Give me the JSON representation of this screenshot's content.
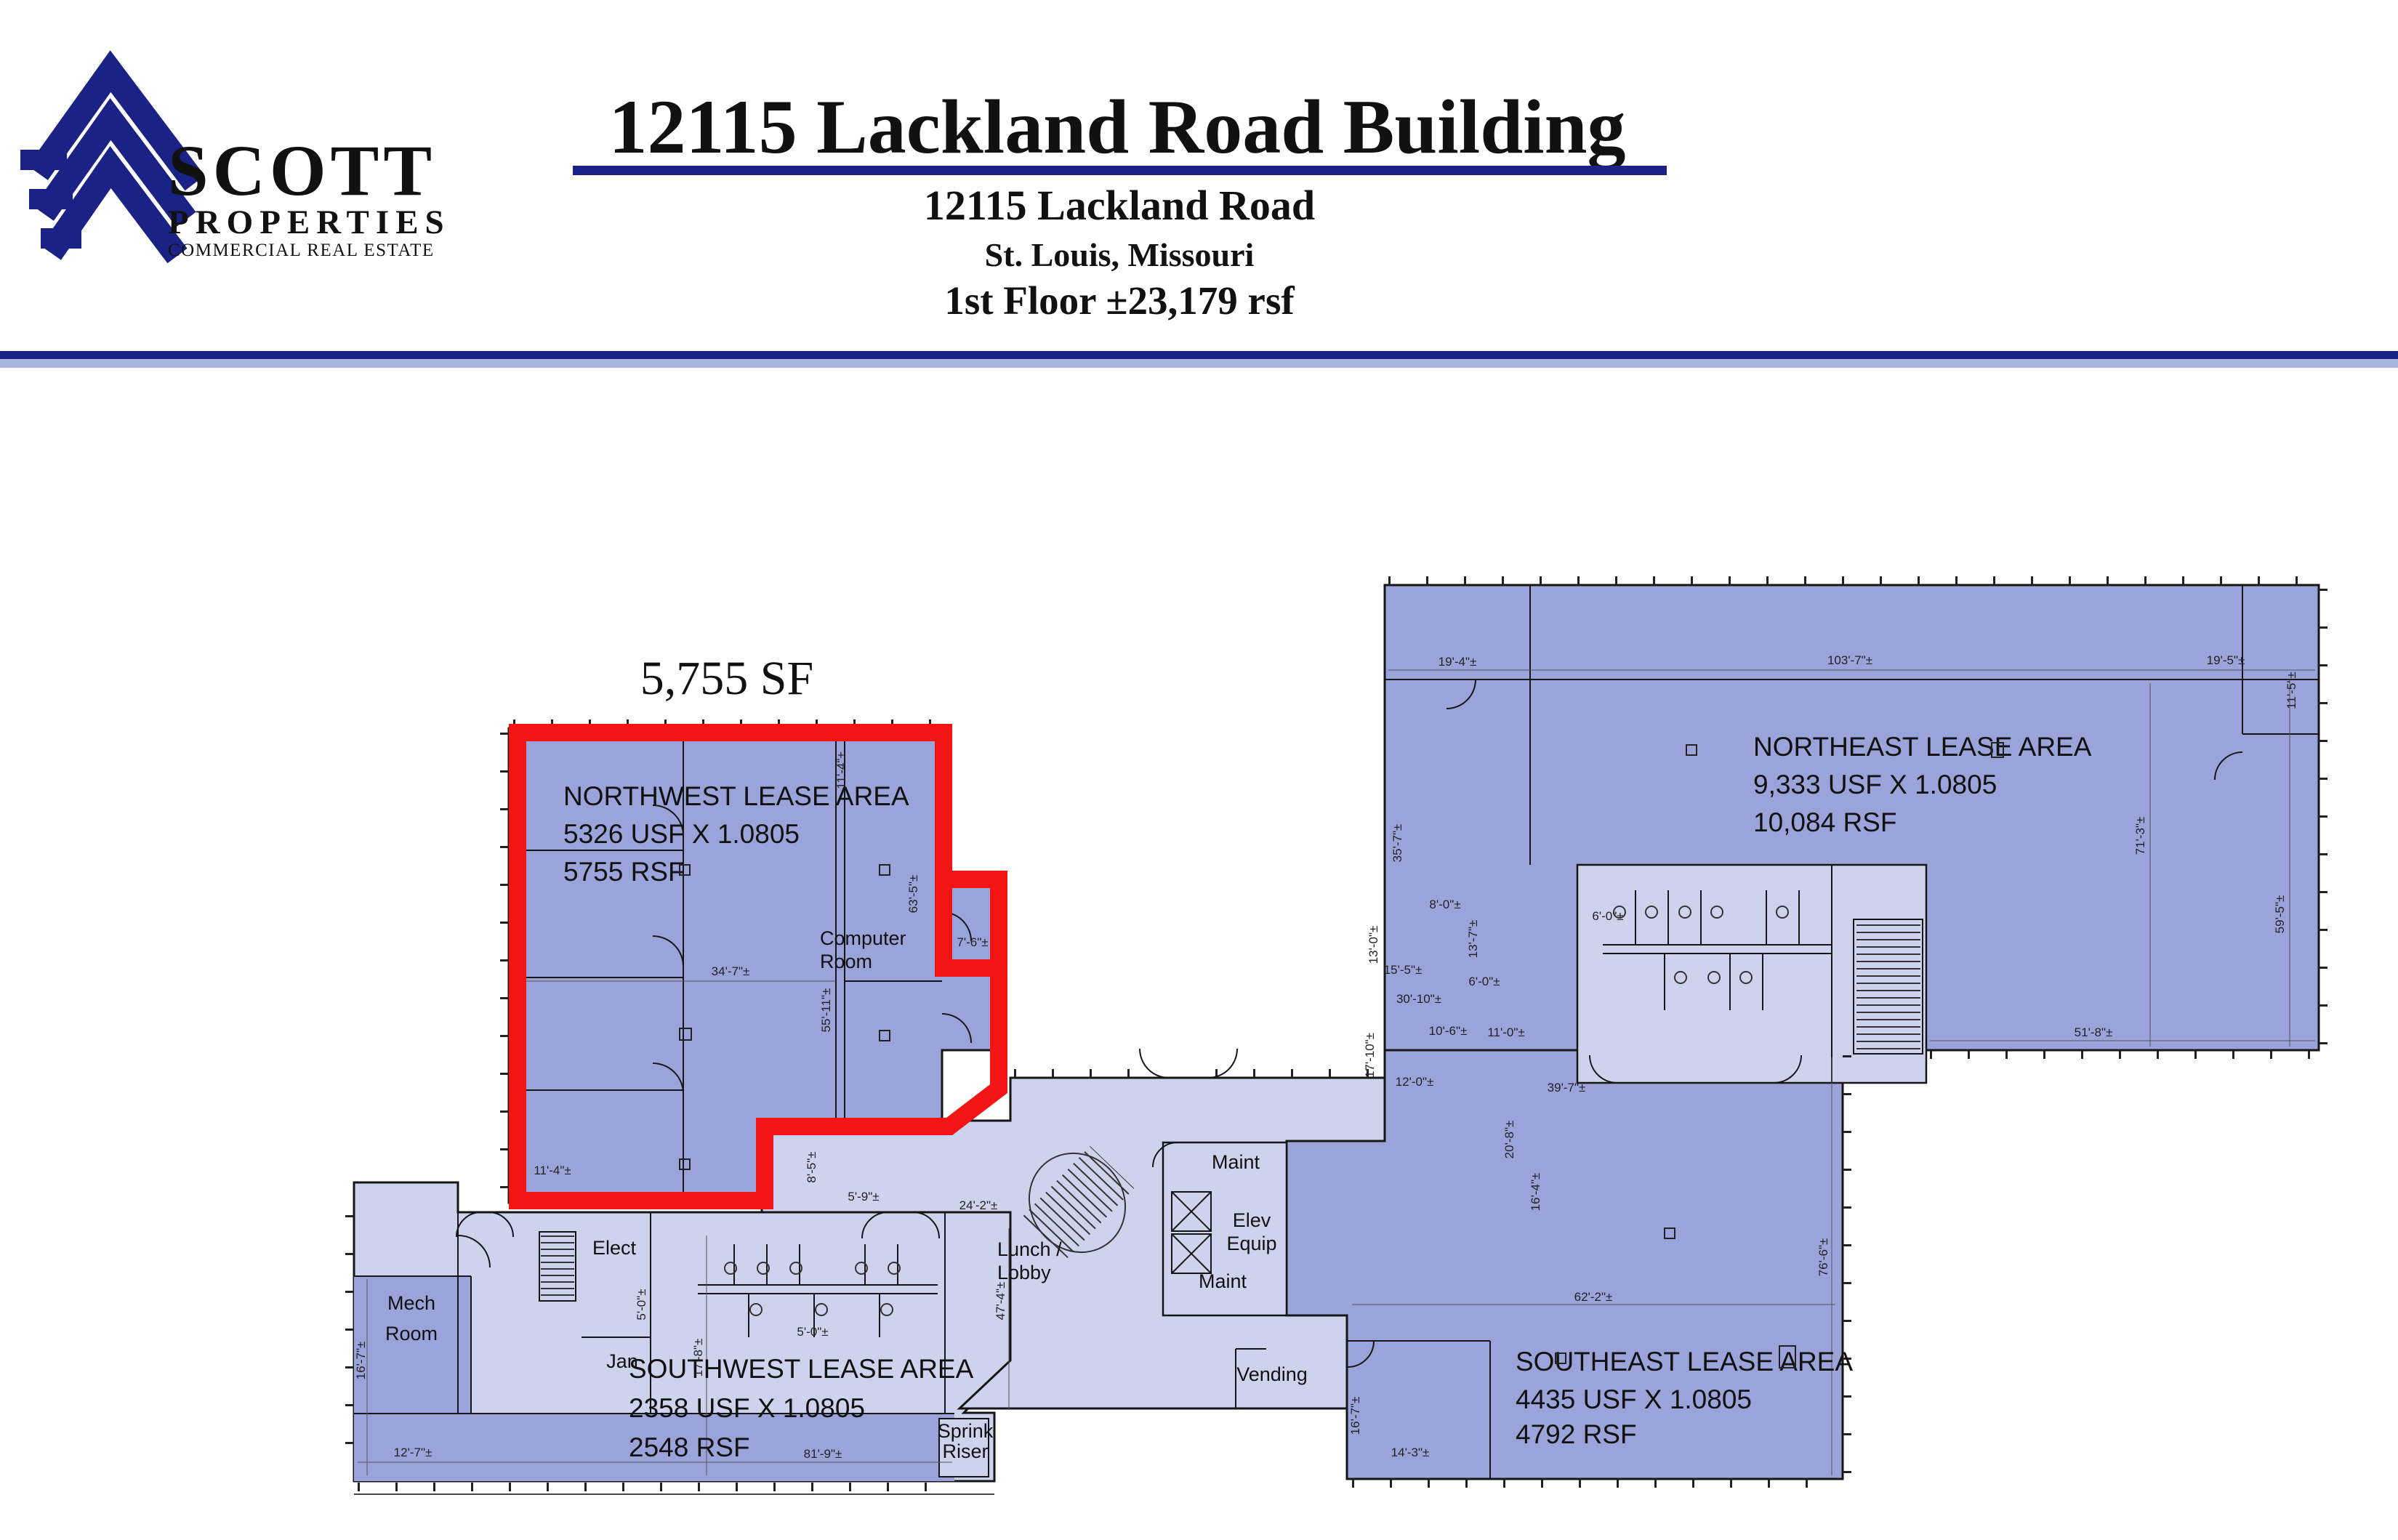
{
  "header": {
    "logo": {
      "line1": "SCOTT",
      "line2": "PROPERTIES",
      "line3": "COMMERCIAL REAL ESTATE"
    },
    "title": "12115 Lackland Road Building",
    "address": "12115 Lackland Road",
    "city": "St. Louis, Missouri",
    "floor": "1st Floor  ±23,179 rsf"
  },
  "plan": {
    "highlight_sf": "5,755 SF",
    "areas": {
      "northwest": {
        "name": "NORTHWEST LEASE AREA",
        "usf": "5326 USF X 1.0805",
        "rsf": "5755 RSF"
      },
      "northeast": {
        "name": "NORTHEAST LEASE AREA",
        "usf": "9,333 USF X 1.0805",
        "rsf": "10,084 RSF"
      },
      "southwest": {
        "name": "SOUTHWEST LEASE AREA",
        "usf": "2358 USF X 1.0805",
        "rsf": "2548 RSF"
      },
      "southeast": {
        "name": "SOUTHEAST LEASE AREA",
        "usf": "4435 USF X 1.0805",
        "rsf": "4792 RSF"
      }
    },
    "rooms": {
      "computer1": "Computer",
      "computer2": "Room",
      "mech1": "Mech",
      "mech2": "Room",
      "elect": "Elect",
      "jan": "Jan",
      "lunch1": "Lunch /",
      "lunch2": "Lobby",
      "vending": "Vending",
      "maint_upper": "Maint",
      "maint_lower": "Maint",
      "elev1": "Elev",
      "elev2": "Equip",
      "sprink1": "Sprink",
      "sprink2": "Riser"
    },
    "colors": {
      "lease": "#9aa4da",
      "common": "#cdd3ec",
      "highlight": "#f31414",
      "navy": "#1b2285"
    },
    "dims": [
      {
        "t": "11'-4\"±"
      },
      {
        "t": "55'-11\"±"
      },
      {
        "t": "63'-5\"±"
      },
      {
        "t": "34'-7\"±"
      },
      {
        "t": "7'-6\"±"
      },
      {
        "t": "11'-4\"±"
      },
      {
        "t": "8'-5\"±"
      },
      {
        "t": "5'-9\"±"
      },
      {
        "t": "16'-7\"±"
      },
      {
        "t": "12'-7\"±"
      },
      {
        "t": "17'-8\"±"
      },
      {
        "t": "5'-0\"±"
      },
      {
        "t": "5'-0\"±"
      },
      {
        "t": "81'-9\"±"
      },
      {
        "t": "24'-2\"±"
      },
      {
        "t": "19'-4\"±"
      },
      {
        "t": "103'-7\"±"
      },
      {
        "t": "19'-5\"±"
      },
      {
        "t": "11'-5\"±"
      },
      {
        "t": "35'-7\"±"
      },
      {
        "t": "71'-3\"±"
      },
      {
        "t": "59'-5\"±"
      },
      {
        "t": "8'-0\"±"
      },
      {
        "t": "13'-7\"±"
      },
      {
        "t": "13'-0\"±"
      },
      {
        "t": "15'-5\"±"
      },
      {
        "t": "30'-10\"±"
      },
      {
        "t": "17'-10\"±"
      },
      {
        "t": "10'-6\"±"
      },
      {
        "t": "12'-0\"±"
      },
      {
        "t": "6'-0\"±"
      },
      {
        "t": "39'-7\"±"
      },
      {
        "t": "20'-8\"±"
      },
      {
        "t": "16'-4\"±"
      },
      {
        "t": "11'-0\"±"
      },
      {
        "t": "51'-8\"±"
      },
      {
        "t": "62'-2\"±"
      },
      {
        "t": "76'-6\"±"
      },
      {
        "t": "16'-7\"±"
      },
      {
        "t": "14'-3\"±"
      },
      {
        "t": "6'-0\"±"
      },
      {
        "t": "47'-4\"±"
      }
    ]
  }
}
